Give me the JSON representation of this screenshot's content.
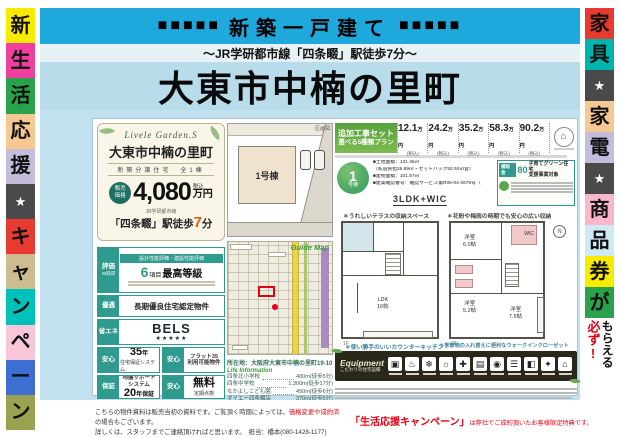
{
  "banner": {
    "squares_left": "■■■■■",
    "title": "新築一戸建て",
    "squares_right": "■■■■■",
    "subtitle": "〜JR学研都市線「四条畷」駅徒歩7分〜",
    "main_title": "大東市中楠の里町"
  },
  "left_strip": [
    {
      "text": "新",
      "bg": "#f7ec00",
      "fg": "#111"
    },
    {
      "text": "生",
      "bg": "#ef3f9f",
      "fg": "#111"
    },
    {
      "text": "活",
      "bg": "#2aa24b",
      "fg": "#111"
    },
    {
      "text": "応",
      "bg": "#f6c892",
      "fg": "#111"
    },
    {
      "text": "援",
      "bg": "#c5bcdc",
      "fg": "#111"
    },
    {
      "text": "★",
      "bg": "#4a4a4a",
      "fg": "#ffffff"
    },
    {
      "text": "キ",
      "bg": "#e73a30",
      "fg": "#111"
    },
    {
      "text": "ャ",
      "bg": "#cdbb92",
      "fg": "#111"
    },
    {
      "text": "ン",
      "bg": "#00c2b8",
      "fg": "#111"
    },
    {
      "text": "ペ",
      "bg": "#f8c6d8",
      "fg": "#111"
    },
    {
      "text": "ー",
      "bg": "#3d6fd2",
      "fg": "#111"
    },
    {
      "text": "ン",
      "bg": "#9aa14f",
      "fg": "#111"
    }
  ],
  "right_strip": [
    {
      "text": "家",
      "bg": "#e73a30",
      "fg": "#111"
    },
    {
      "text": "具",
      "bg": "#00b5ad",
      "fg": "#111"
    },
    {
      "text": "★",
      "bg": "#4a4a4a",
      "fg": "#ffffff"
    },
    {
      "text": "家",
      "bg": "#f6c892",
      "fg": "#111"
    },
    {
      "text": "電",
      "bg": "#c5bcdc",
      "fg": "#111"
    },
    {
      "text": "★",
      "bg": "#4a4a4a",
      "fg": "#ffffff"
    },
    {
      "text": "商",
      "bg": "#f8b7cd",
      "fg": "#111"
    },
    {
      "text": "品",
      "bg": "#cfe9f5",
      "fg": "#111"
    },
    {
      "text": "券",
      "bg": "#f7ec00",
      "fg": "#111"
    },
    {
      "text": "が",
      "bg": "#2aa24b",
      "fg": "#111"
    }
  ],
  "right_strip_bottom": {
    "red": "必ず!",
    "black": "もらえる"
  },
  "property_card": {
    "logo": "Livele Garden.S",
    "name": "大東市中楠の里町",
    "subtitle": "新築分譲住宅　全1棟",
    "price_badge": "販売\n価格",
    "price": "4,080",
    "price_tax": "税込",
    "price_unit": "万円",
    "station_small": "JR学研都市線",
    "station_pre": "「四条畷」駅徒歩",
    "station_num": "7",
    "station_post": "分"
  },
  "badges": {
    "b1": {
      "tag1": "評価",
      "tag2": "W取得",
      "header": "設計性能評価・建設性能評価",
      "num": "6",
      "num_suffix": "項目",
      "big": "最高等級"
    },
    "b2": {
      "tag": "優遇",
      "title": "長期優良住宅認定物件"
    },
    "b3": {
      "tag": "省エネ",
      "title": "BELS",
      "stars": "★★★★★"
    },
    "b4a": {
      "tag": "安心",
      "big": "35",
      "big_suffix": "年",
      "small": "住宅保証システム"
    },
    "b4b": {
      "tag": "安心",
      "line": "フラット35\n利用可能物件"
    },
    "b5a": {
      "tag": "保証",
      "line": "地盤サポート\nシステム",
      "big": "20",
      "big_suffix": "年保証"
    },
    "b5b": {
      "tag": "安心",
      "big": "無料",
      "small": "定期点検"
    }
  },
  "site_plan": {
    "lot_label": "1号棟",
    "corner_label": "区画図"
  },
  "map": {
    "ribbon": "Guide Map",
    "address": "所在地：大阪府大東市中楠の里町19-10"
  },
  "life_info": {
    "title": "Life Information",
    "items": [
      {
        "name": "四条北小学校",
        "value": "400m(徒歩5分)"
      },
      {
        "name": "四条中学校",
        "value": "1,300m(徒歩17分)"
      },
      {
        "name": "なかよしこども園",
        "value": "450m(徒歩6分)"
      },
      {
        "name": "ダイエー四条畷店",
        "value": "370m(徒歩5分)"
      },
      {
        "name": "ファミリーマート大東深野店",
        "value": "240m(徒歩3分)"
      },
      {
        "name": "大阪信用金庫四条畷支店",
        "value": "250m(徒歩4分)"
      }
    ]
  },
  "plans_header": {
    "label1": "追加工事セット",
    "label2": "選べる5種類プラン",
    "prices": [
      {
        "num": "12.1",
        "unit": "万円",
        "tax": "(税込)"
      },
      {
        "num": "24.2",
        "unit": "万円",
        "tax": "(税込)"
      },
      {
        "num": "35.2",
        "unit": "万円",
        "tax": "(税込)"
      },
      {
        "num": "58.3",
        "unit": "万円",
        "tax": "(税込)"
      },
      {
        "num": "90.2",
        "unit": "万円",
        "tax": "(税込)"
      }
    ]
  },
  "unit": {
    "badge_num": "1",
    "badge_suffix": "号棟",
    "details": [
      "■土地面積：131.45㎡",
      "（私道負担26.89㎡・セットバック52.92㎡含）",
      "■建物面積：101.67㎡",
      "■建築確認番号：確認サービス第R05-04-2679号（R5年11月29日）"
    ],
    "layout": "3LDK+WIC"
  },
  "subsidy": {
    "chip": "補助金",
    "num": "80",
    "title": "子育てグリーン住宅\n支援事業対象"
  },
  "plan_notes": {
    "top_left": "＊うれしいテラスの収納スペース",
    "top_right": "＊花粉や梅雨の時期でも安心の広い収納",
    "bottom_left": "＊使い勝手のいいカウンターキッチン",
    "bottom_right": "＊季節物の入れ替えに便利なウォークインクローゼット"
  },
  "floor_plans": {
    "f1": {
      "caption": "1F",
      "ldk": "LDK\n16帖"
    },
    "f2": {
      "caption": "2F",
      "room1": "洋室\n6.0帖",
      "room2": "洋室\n5.2帖",
      "room3": "洋室\n7.5帖",
      "wic": "WIC"
    },
    "compass": "N"
  },
  "equipment": {
    "title": "Equipment",
    "subtitle": "こだわりの住宅設備",
    "icons": [
      "▣",
      "♨",
      "❄",
      "☼",
      "✚",
      "▤",
      "◉",
      "☰",
      "◧",
      "✦",
      "⌂"
    ]
  },
  "footer": {
    "line1_pre": "こちらの物件資料は販売当初の資料です。ご覧頂く時期によっては、",
    "line1_red": "価格変更や成約済",
    "line1_post": "の場合もございます。",
    "line2": "詳しくは、スタッフまでご連絡頂ければと思います。　担当：橋本(080-1428-1177)",
    "right_big": "「生活応援キャンペーン」",
    "right_small": "は弊社でご成約頂いたお客様限定特典です。"
  }
}
